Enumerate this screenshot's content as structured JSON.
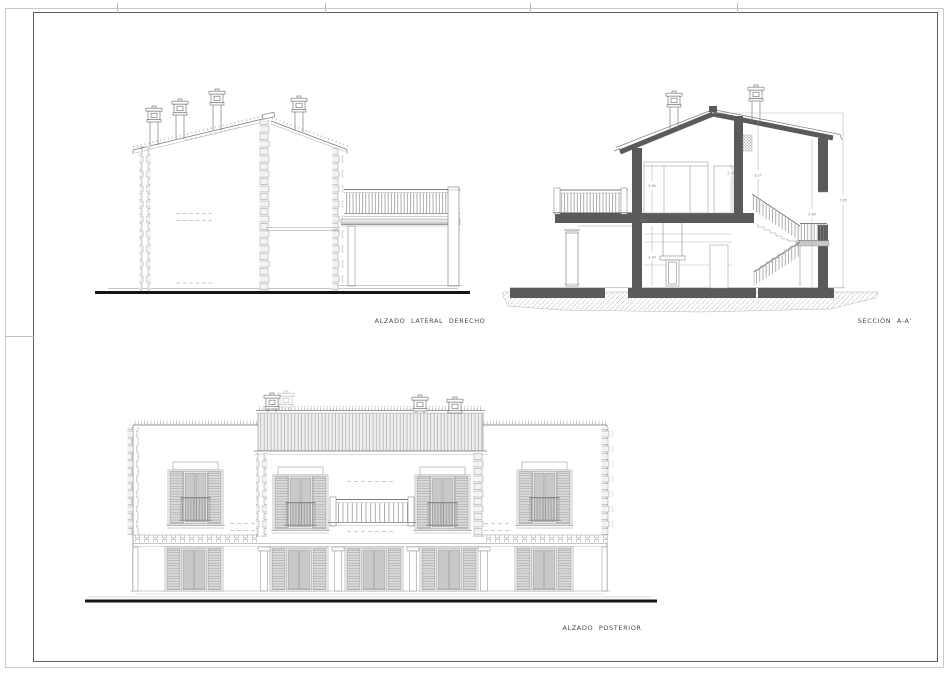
{
  "sheet": {
    "type": "architectural-plan-sheet",
    "labels": {
      "side_elevation": "ALZADO LATERAL DERECHO",
      "section": "SECCIÓN A-A'",
      "rear_elevation": "ALZADO POSTERIOR"
    },
    "section_dimensions": {
      "upper_room": "2.60",
      "slab": "0.40",
      "ground_room": "2.40",
      "upper_wall": "2.75",
      "ridge": "3.27",
      "stair_side": "5.60",
      "total_height": "7.65"
    },
    "colors": {
      "line": "#7d7d7d",
      "light_line": "#a8a8a8",
      "cut_poche": "#5a5a5a",
      "ground_line": "#151515",
      "frame_outer": "#c9c9c9",
      "frame_inner": "#5e5e5e",
      "shutter_fill": "#d8d8d8",
      "glass_fill": "#c9c9c9"
    }
  }
}
